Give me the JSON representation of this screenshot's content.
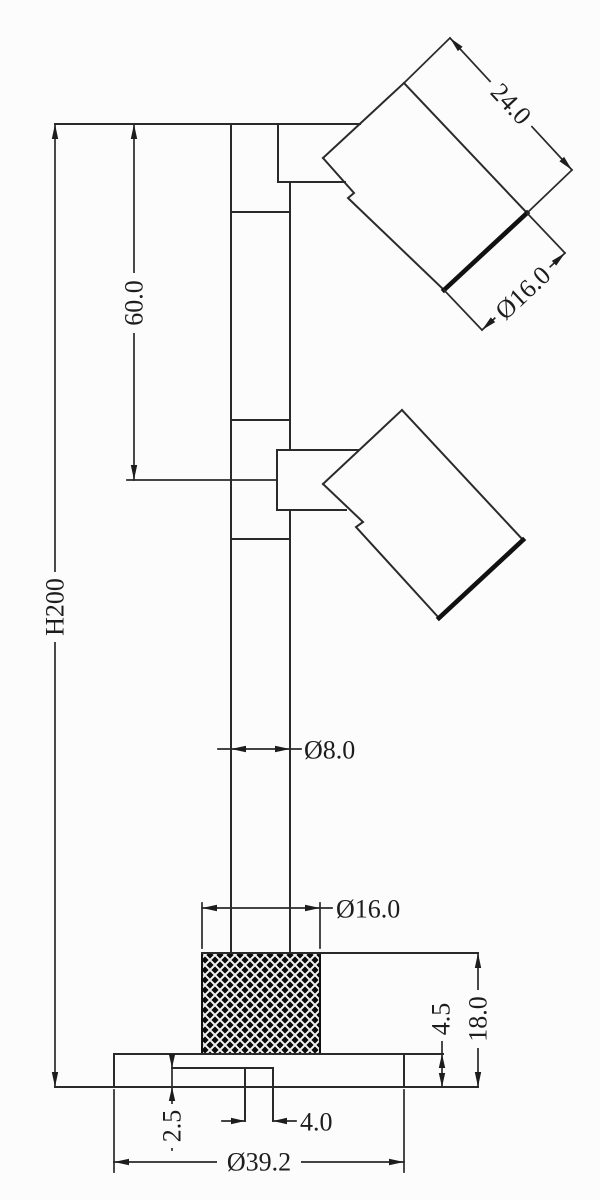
{
  "page": {
    "background": "#fcfcfc",
    "line_color": "#2a2a2a"
  },
  "drawing": {
    "kind": "technical-dimension-drawing",
    "parts": [
      "spotlight-head-top",
      "spotlight-head-middle",
      "mounting-pole",
      "knurled-knob",
      "base-plate"
    ],
    "dimensions": {
      "head_length": "24.0",
      "head_diameter": "Ø16.0",
      "head_spacing": "60.0",
      "total_height": "H200",
      "pole_diameter": "Ø8.0",
      "knob_diameter": "Ø16.0",
      "base_plate_thickness": "4.5",
      "base_assembly_height": "18.0",
      "recess_depth": "2.5",
      "stem_width": "4.0",
      "base_diameter": "Ø39.2"
    }
  }
}
